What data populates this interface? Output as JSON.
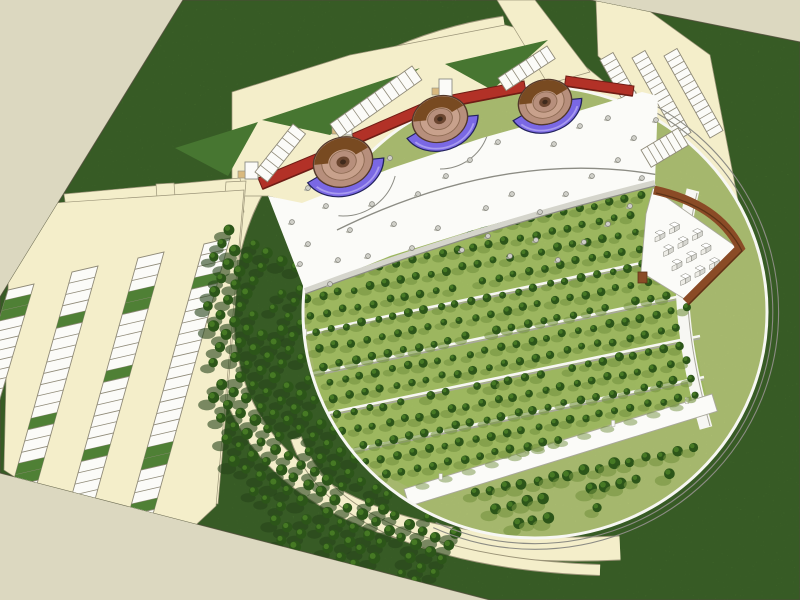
{
  "meta": {
    "scene": "aerial-3d-architectural-site-plan-render",
    "style": "sketchup-like-model",
    "canvas": {
      "w": 800,
      "h": 600
    }
  },
  "palette": {
    "bg": "#dcd8c0",
    "grass": "#4f8035",
    "grassDark": "#477631",
    "siteEdge": "#6a6a50",
    "cream": "#f4eeca",
    "creamEdge": "#9b9478",
    "white": "#fbfbf8",
    "stallLine": "#8f8a78",
    "lawn": "#b9cd7a",
    "orchardGround": "#abc768",
    "treeDark": "#2c5519",
    "treeLit": "#497d26",
    "shadowLight": "#74923f",
    "shadowDark": "#27451b",
    "red": "#b23127",
    "redDark": "#6f1d15",
    "blue": "#7a68e4",
    "blueDark": "#23235e",
    "blueLight": "#a89bf0",
    "bowlRing": "#b78f7c",
    "bowlRing2": "#c8a18c",
    "bowlDark": "#784a21",
    "bowlCenter": "#6b4630",
    "bowlPit": "#3f2a1c",
    "brown": "#8a4b26",
    "brownDark": "#5e3317",
    "grey": "#8c8c84",
    "greyLight": "#d5d5cc",
    "dotFill": "#cfcfc8",
    "dotEdge": "#7e7e76",
    "cubeSide": "#d7d7d1",
    "cubeLeft": "#edece6",
    "cubeEdge": "#85857c",
    "wallWhite": "#f7f7f3",
    "wallShade": "#a9a89c",
    "tan": "#d9b97e"
  },
  "site": {
    "outline": [
      [
        183,
        0
      ],
      [
        590,
        0
      ],
      [
        800,
        42
      ],
      [
        800,
        600
      ],
      [
        490,
        600
      ],
      [
        0,
        473
      ],
      [
        0,
        297
      ]
    ]
  },
  "circle": {
    "cx": 535,
    "cy": 312,
    "rx": 232,
    "ry": 226
  },
  "ring_road": {
    "center_d": "M505,28 C330,55 218,170 222,320 C226,470 360,560 620,548",
    "width": 23,
    "ribbon_d": "M296,438 C322,516 430,564 600,570",
    "ribbon_width": 10
  },
  "roads": {
    "polys": [
      [
        [
          232,
          180
        ],
        [
          232,
          92
        ],
        [
          350,
          55
        ],
        [
          505,
          25
        ],
        [
          548,
          36
        ],
        [
          612,
          88
        ],
        [
          640,
          92
        ],
        [
          572,
          114
        ],
        [
          482,
          140
        ],
        [
          392,
          170
        ],
        [
          302,
          205
        ],
        [
          268,
          196
        ],
        [
          240,
          196
        ]
      ],
      [
        [
          497,
          0
        ],
        [
          535,
          0
        ],
        [
          590,
          72
        ],
        [
          548,
          84
        ]
      ],
      [
        [
          598,
          0
        ],
        [
          632,
          0
        ],
        [
          664,
          46
        ],
        [
          636,
          58
        ]
      ],
      [
        [
          596,
          0
        ],
        [
          634,
          0
        ],
        [
          710,
          55
        ],
        [
          748,
          252
        ],
        [
          655,
          182
        ],
        [
          636,
          92
        ],
        [
          598,
          56
        ]
      ],
      [
        [
          64,
          194
        ],
        [
          240,
          178
        ],
        [
          242,
          192
        ],
        [
          66,
          208
        ]
      ],
      [
        [
          58,
          216
        ],
        [
          242,
          198
        ],
        [
          244,
          212
        ],
        [
          60,
          230
        ]
      ],
      [
        [
          226,
          182
        ],
        [
          246,
          181
        ],
        [
          218,
          504
        ],
        [
          200,
          500
        ]
      ],
      [
        [
          156,
          184
        ],
        [
          174,
          183
        ],
        [
          178,
          240
        ],
        [
          160,
          242
        ]
      ],
      [
        [
          10,
          206
        ],
        [
          244,
          190
        ],
        [
          216,
          506
        ],
        [
          152,
          566
        ],
        [
          4,
          470
        ]
      ]
    ],
    "green_spikes": [
      [
        [
          262,
          120
        ],
        [
          420,
          68
        ],
        [
          330,
          135
        ]
      ],
      [
        [
          445,
          64
        ],
        [
          548,
          40
        ],
        [
          492,
          90
        ]
      ],
      [
        [
          175,
          148
        ],
        [
          258,
          122
        ],
        [
          228,
          176
        ]
      ]
    ]
  },
  "parking_left": {
    "off": [
      26,
      -6
    ],
    "n": 26,
    "green_rate": 0.16,
    "strips": [
      [
        8,
        290,
        -72,
        560
      ],
      [
        72,
        272,
        -10,
        565
      ],
      [
        138,
        258,
        56,
        552
      ],
      [
        204,
        244,
        122,
        538
      ]
    ]
  },
  "parking_top_right": {
    "off": [
      13,
      -7.5
    ],
    "n": 13,
    "strips": [
      [
        600,
        60,
        646,
        142
      ],
      [
        632,
        58,
        678,
        140
      ],
      [
        664,
        56,
        710,
        138
      ]
    ]
  },
  "plaza": {
    "poly": [
      [
        268,
        196
      ],
      [
        302,
        203
      ],
      [
        392,
        168
      ],
      [
        482,
        138
      ],
      [
        572,
        113
      ],
      [
        642,
        92
      ],
      [
        658,
        96
      ],
      [
        655,
        183
      ],
      [
        570,
        203
      ],
      [
        480,
        228
      ],
      [
        390,
        256
      ],
      [
        305,
        291
      ]
    ],
    "edge_d": "M305,291 Q480,226 655,183",
    "edge_d2": "M305,294 Q480,229 655,186",
    "arc_d": "M337,230 Q530,135 706,186",
    "ground_arcs": [
      [
        343,
        162,
        54,
        15,
        95
      ],
      [
        440,
        119,
        50,
        20,
        90
      ]
    ],
    "dots": [
      [
        292,
        222
      ],
      [
        308,
        244
      ],
      [
        326,
        206
      ],
      [
        350,
        230
      ],
      [
        372,
        204
      ],
      [
        394,
        224
      ],
      [
        368,
        256
      ],
      [
        338,
        260
      ],
      [
        412,
        248
      ],
      [
        438,
        228
      ],
      [
        462,
        250
      ],
      [
        488,
        236
      ],
      [
        510,
        256
      ],
      [
        536,
        240
      ],
      [
        558,
        260
      ],
      [
        584,
        242
      ],
      [
        608,
        224
      ],
      [
        630,
        206
      ],
      [
        486,
        208
      ],
      [
        512,
        194
      ],
      [
        540,
        212
      ],
      [
        566,
        194
      ],
      [
        592,
        176
      ],
      [
        618,
        160
      ],
      [
        642,
        178
      ],
      [
        654,
        158
      ],
      [
        418,
        194
      ],
      [
        446,
        176
      ],
      [
        390,
        158
      ],
      [
        362,
        176
      ],
      [
        336,
        178
      ],
      [
        308,
        188
      ],
      [
        470,
        160
      ],
      [
        498,
        142
      ],
      [
        526,
        126
      ],
      [
        554,
        144
      ],
      [
        580,
        126
      ],
      [
        608,
        118
      ],
      [
        634,
        138
      ],
      [
        656,
        120
      ],
      [
        300,
        264
      ],
      [
        330,
        284
      ]
    ]
  },
  "orchard": {
    "poly": [
      [
        305,
        291
      ],
      [
        390,
        256
      ],
      [
        480,
        228
      ],
      [
        570,
        203
      ],
      [
        655,
        184
      ],
      [
        646,
        262
      ],
      [
        686,
        300
      ],
      [
        702,
        378
      ],
      [
        706,
        394
      ],
      [
        408,
        487
      ],
      [
        372,
        468
      ],
      [
        340,
        438
      ],
      [
        318,
        390
      ],
      [
        308,
        334
      ]
    ],
    "grid": {
      "o": [
        298,
        266
      ],
      "u": [
        15.6,
        -3.2
      ],
      "v": [
        4.4,
        16.6
      ],
      "ni": 28,
      "nj": 15
    },
    "walls": [
      [
        302,
        334,
        646,
        262
      ],
      [
        300,
        376,
        686,
        295
      ],
      [
        304,
        418,
        700,
        336
      ],
      [
        314,
        458,
        704,
        377
      ]
    ],
    "below": {
      "poly": [
        [
          430,
          506
        ],
        [
          706,
          410
        ],
        [
          694,
          462
        ],
        [
          560,
          528
        ],
        [
          468,
          524
        ]
      ],
      "grid": {
        "o": [
          428,
          503
        ],
        "u": [
          15.6,
          -3.2
        ],
        "v": [
          6,
          18
        ],
        "ni": 19,
        "nj": 3
      },
      "rate": 0.7
    }
  },
  "stepped": {
    "d": "M693,190 C676,255 678,330 706,428",
    "d2": "M697,193 C681,256 683,330 710,426"
  },
  "promenade": {
    "x1": 404,
    "y1": 489,
    "x2": 712,
    "y2": 394,
    "w": 18,
    "shadow_n": 12
  },
  "wedge": {
    "poly": [
      [
        653,
        188
      ],
      [
        738,
        248
      ],
      [
        686,
        300
      ],
      [
        641,
        272
      ],
      [
        646,
        214
      ]
    ],
    "wall_d": "M654,190 Q718,204 740,248 L686,302",
    "post": [
      638,
      272,
      9,
      11
    ],
    "cubes": {
      "o": [
        660,
        234
      ],
      "u": [
        14.5,
        -8
      ],
      "v": [
        8.5,
        14.5
      ],
      "ni": 5,
      "nj": 5,
      "poly": [
        [
          654,
          194
        ],
        [
          732,
          248
        ],
        [
          684,
          294
        ],
        [
          646,
          268
        ],
        [
          648,
          214
        ]
      ]
    }
  },
  "red_walls": [
    [
      258,
      178,
      330,
      148,
      4.6,
      11.1,
      1
    ],
    [
      352,
      134,
      421,
      104,
      4.4,
      10.1,
      1
    ],
    [
      452,
      95,
      524,
      81,
      2.1,
      10.8,
      1
    ],
    [
      566,
      76,
      634,
      86,
      -1.5,
      9.9,
      0
    ]
  ],
  "ladders": [
    [
      255,
      172,
      293,
      124,
      12.5,
      9.9,
      7
    ],
    [
      330,
      124,
      412,
      66,
      9.8,
      13.9,
      11
    ],
    [
      498,
      78,
      547,
      46,
      8.2,
      12.6,
      7
    ],
    [
      641,
      150,
      678,
      128,
      10.2,
      17.2,
      6
    ]
  ],
  "bowls": [
    {
      "cx": 343,
      "cy": 162,
      "r": 30,
      "rot": -18
    },
    {
      "cx": 440,
      "cy": 119,
      "r": 28,
      "rot": -18
    },
    {
      "cx": 545,
      "cy": 102,
      "r": 27,
      "rot": -18
    }
  ],
  "grove": {
    "poly": [
      [
        228,
        218
      ],
      [
        300,
        248
      ],
      [
        312,
        330
      ],
      [
        340,
        430
      ],
      [
        388,
        490
      ],
      [
        470,
        540
      ],
      [
        432,
        586
      ],
      [
        300,
        572
      ],
      [
        214,
        430
      ],
      [
        204,
        256
      ]
    ],
    "grid": {
      "o": [
        214,
        222
      ],
      "u": [
        13.5,
        7.5
      ],
      "v": [
        -6.8,
        13.8
      ],
      "ni": 26,
      "nj": 27
    },
    "rate": 0.9
  },
  "rim_rails": {
    "start": 300,
    "len": 175,
    "scales": [
      1.025,
      1.05
    ]
  }
}
